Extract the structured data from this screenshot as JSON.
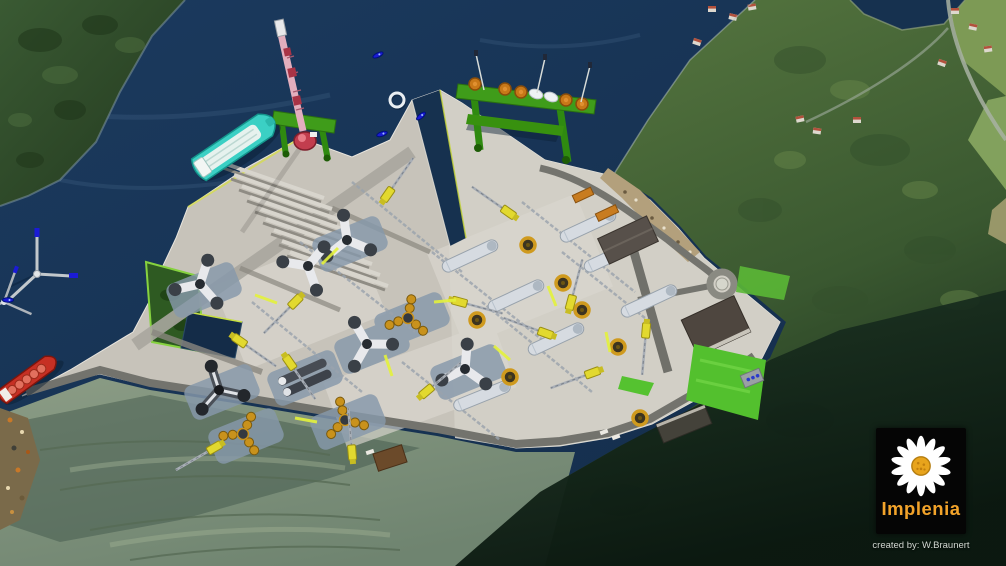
{
  "image": {
    "kind": "3d-aerial-visualization",
    "subject": "Coastal fjord harbour / offshore wind turbine assembly yard with quays, cranes, tri-star foundations, gantries, ships and surrounding hills",
    "width_px": 1006,
    "height_px": 566
  },
  "branding": {
    "logo_text": "Implenia",
    "logo_text_color": "#f2a32a",
    "logo_background": "#050505",
    "logo_icon": "daisy-flower",
    "attribution": "created by: W.Braunert"
  },
  "palette": {
    "water": "#16314f",
    "water_light": "#1e3e63",
    "forest_dark": "#2c4829",
    "hill_green": "#4c6b3c",
    "field_green": "#7d9a55",
    "quarry_sage": "#81947d",
    "quay_concrete": "#c7c3ba",
    "quay_light": "#d9d6ce",
    "road_gray": "#73736d",
    "pad_blue_gray": "#8799ab",
    "crane_yellow": "#e2d92f",
    "ring_gold": "#cf9a1e",
    "gantry_green": "#3f9c1a",
    "crane_pink": "#e8b2c0",
    "ship_teal": "#3ed2c6",
    "ship_red": "#c83226",
    "boat_blue": "#1b1bd6",
    "lawn_green": "#53c02e"
  },
  "scene_objects": [
    "fjord-water",
    "forested-hill-northwest",
    "eastern-hillside-with-houses",
    "hillside-road",
    "rock-quarry-terraces",
    "harbour-quay-platform-west",
    "harbour-quay-platform-east",
    "water-channel-between-quays",
    "dock-basin",
    "tower-section-storage-rows",
    "tri-star-floating-foundations",
    "gold-ring-foundation-sections",
    "yellow-crawler-cranes",
    "turbine-tower-cylinders",
    "assembly-bay-pads",
    "green-load-out-gantry",
    "orange-tower-section-ends",
    "white-nacelles",
    "pink-heavy-lift-crane",
    "teal-installation-vessel",
    "red-cargo-ship",
    "floating-wind-turbines",
    "blue-support-boats",
    "white-mooring-ring",
    "roundabout",
    "warehouse-buildings",
    "orange-containers",
    "green-lawns",
    "vegetated-embankment",
    "implenia-logo",
    "attribution-credit"
  ]
}
